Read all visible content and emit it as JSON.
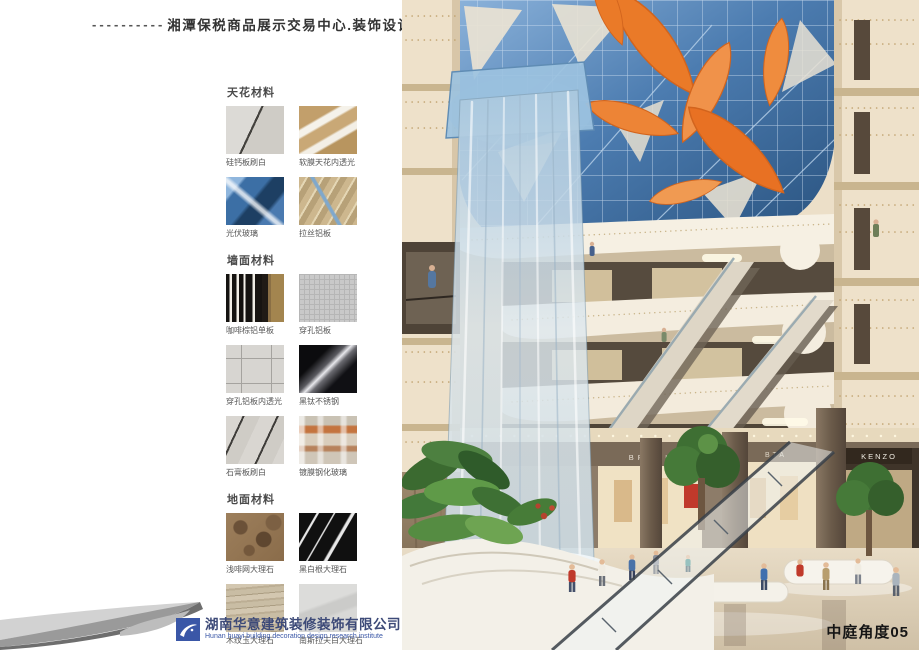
{
  "page": {
    "title_dashes": "----------",
    "title": "湘潭保税商品展示交易中心.装饰设计"
  },
  "materials": {
    "sections": [
      {
        "heading": "天花材料",
        "items": [
          {
            "label": "硅钙板刷白"
          },
          {
            "label": "软膜天花内透光"
          },
          {
            "label": "光伏玻璃"
          },
          {
            "label": "拉丝铝板"
          }
        ]
      },
      {
        "heading": "墙面材料",
        "items": [
          {
            "label": "咖啡棕铝单板"
          },
          {
            "label": "穿孔铝板"
          },
          {
            "label": "穿孔铝板内透光"
          },
          {
            "label": "黑钛不锈钢"
          },
          {
            "label": "石膏板刷白"
          },
          {
            "label": "镀膜钢化玻璃"
          }
        ]
      },
      {
        "heading": "地面材料",
        "items": [
          {
            "label": "浅啡网大理石"
          },
          {
            "label": "黑白根大理石"
          },
          {
            "label": "木纹玉大理石"
          },
          {
            "label": "南斯拉夫白大理石"
          }
        ]
      }
    ]
  },
  "footer": {
    "company_cn": "湖南华意建筑装修装饰有限公司",
    "company_en": "Hunan huayi building decoration design research institute"
  },
  "render": {
    "caption": "中庭角度05",
    "signs": {
      "upper_shop": "BRUTI",
      "shop_left": "BRUTI",
      "shop_mid": "BTA",
      "shop_right": "KENZO"
    },
    "colors": {
      "skylight_blue": "#4d7fb5",
      "leaf_orange": "#e87a2c",
      "structure_cream": "#ecdfc8",
      "logo_blue": "#3a57a7"
    }
  }
}
